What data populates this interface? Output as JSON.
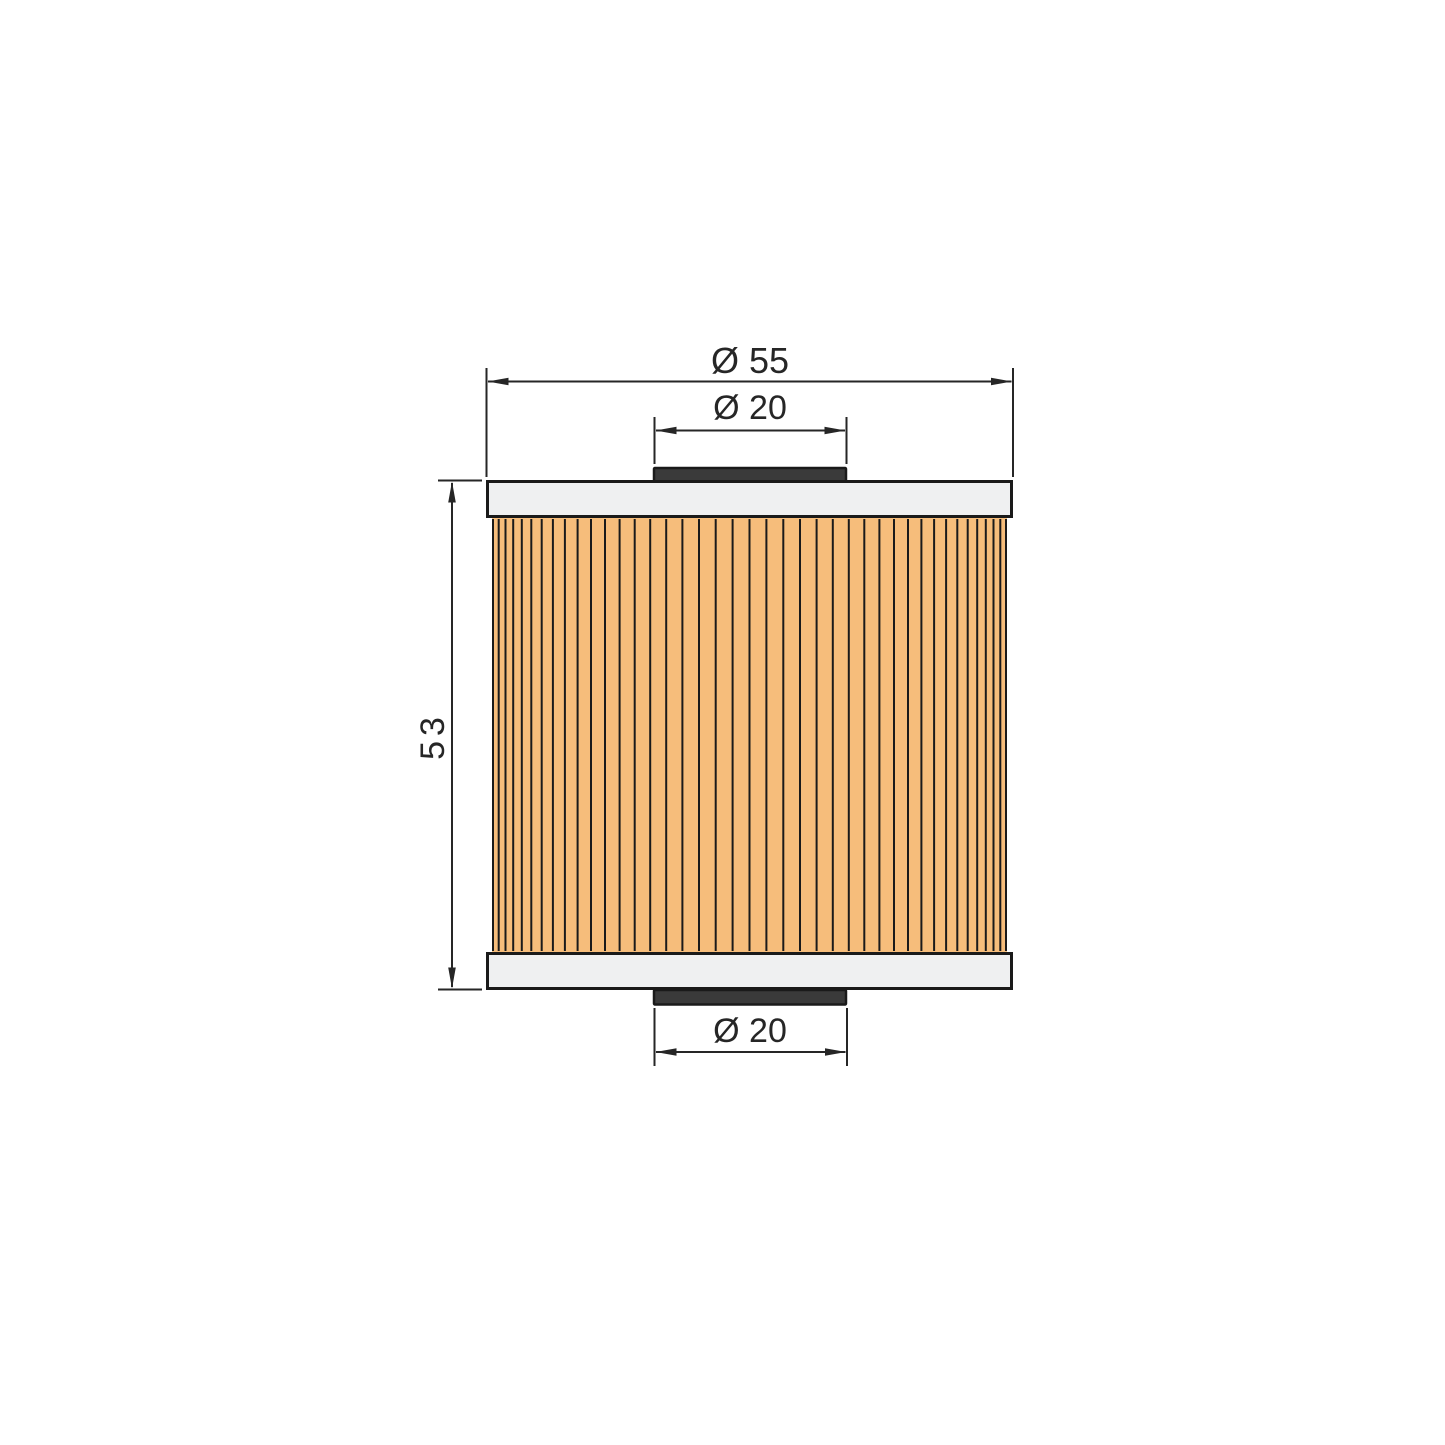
{
  "drawing": {
    "part_name": "pleated-filter-element",
    "dimensions": {
      "outer_diameter": "Ø 55",
      "top_inner_diameter": "Ø 20",
      "height": "53",
      "bottom_inner_diameter": "Ø 20"
    },
    "colors": {
      "background": "#ffffff",
      "filter_media": "#f6bd7b",
      "end_cap": "#eff0f1",
      "gasket": "#3a3a3a",
      "line": "#1a1a1a",
      "dim_line": "#262626"
    },
    "pleat_count": 41
  }
}
